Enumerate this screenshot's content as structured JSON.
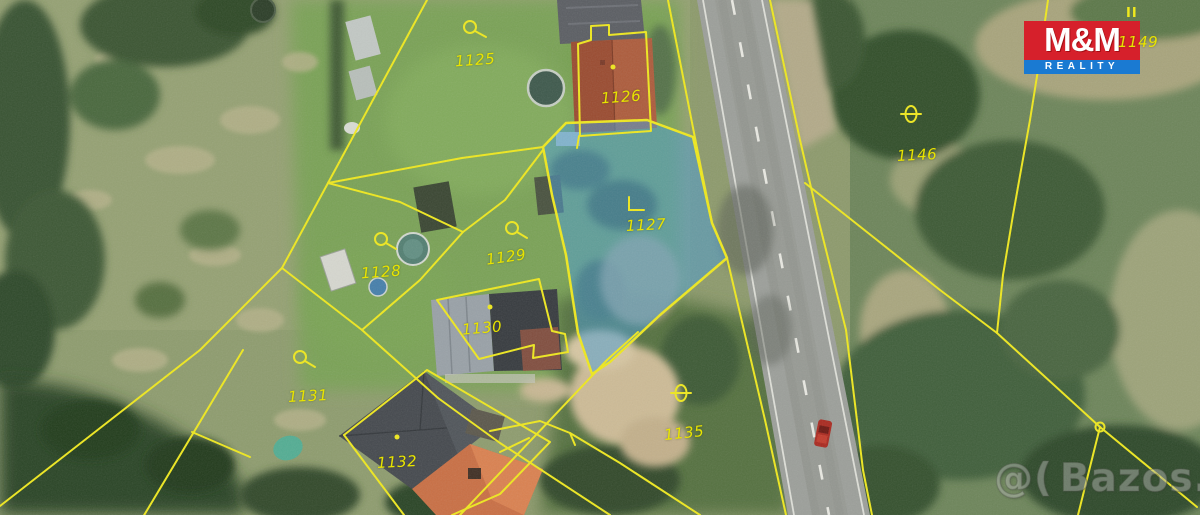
{
  "map": {
    "description": "aerial cadastral map with parcel boundaries",
    "highlighted_parcel": "1127",
    "line_color": "#efe81e",
    "highlight_fill": "#4a9ad0",
    "parcel_labels": {
      "p1125": "1125",
      "p1126": "1126",
      "p1127": "1127",
      "p1128": "1128",
      "p1129": "1129",
      "p1130": "1130",
      "p1131": "1131",
      "p1132": "1132",
      "p1135": "1135",
      "p1146": "1146",
      "p1149": "1149"
    },
    "symbol_marks": "II"
  },
  "branding": {
    "logo_top": "M&M",
    "logo_bottom": "REALITY",
    "logo_red": "#d6202b",
    "logo_blue": "#1a7ad2"
  },
  "watermark": {
    "mark": "@(",
    "text": "Bazos.cz"
  }
}
